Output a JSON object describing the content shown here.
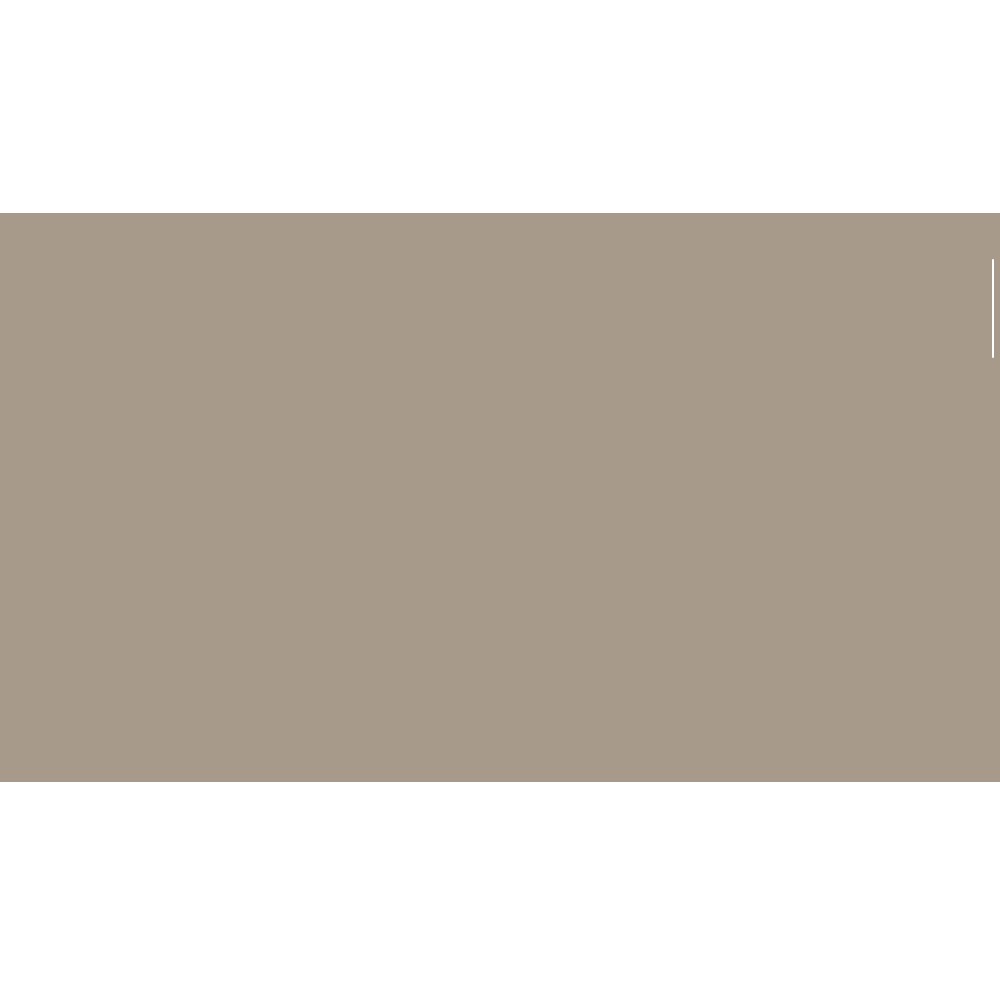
{
  "colors": {
    "page_background": "#ffffff",
    "content_band": "#a89a8b",
    "scrollbar_thumb": "#ffffff"
  },
  "content": {
    "text": ""
  }
}
